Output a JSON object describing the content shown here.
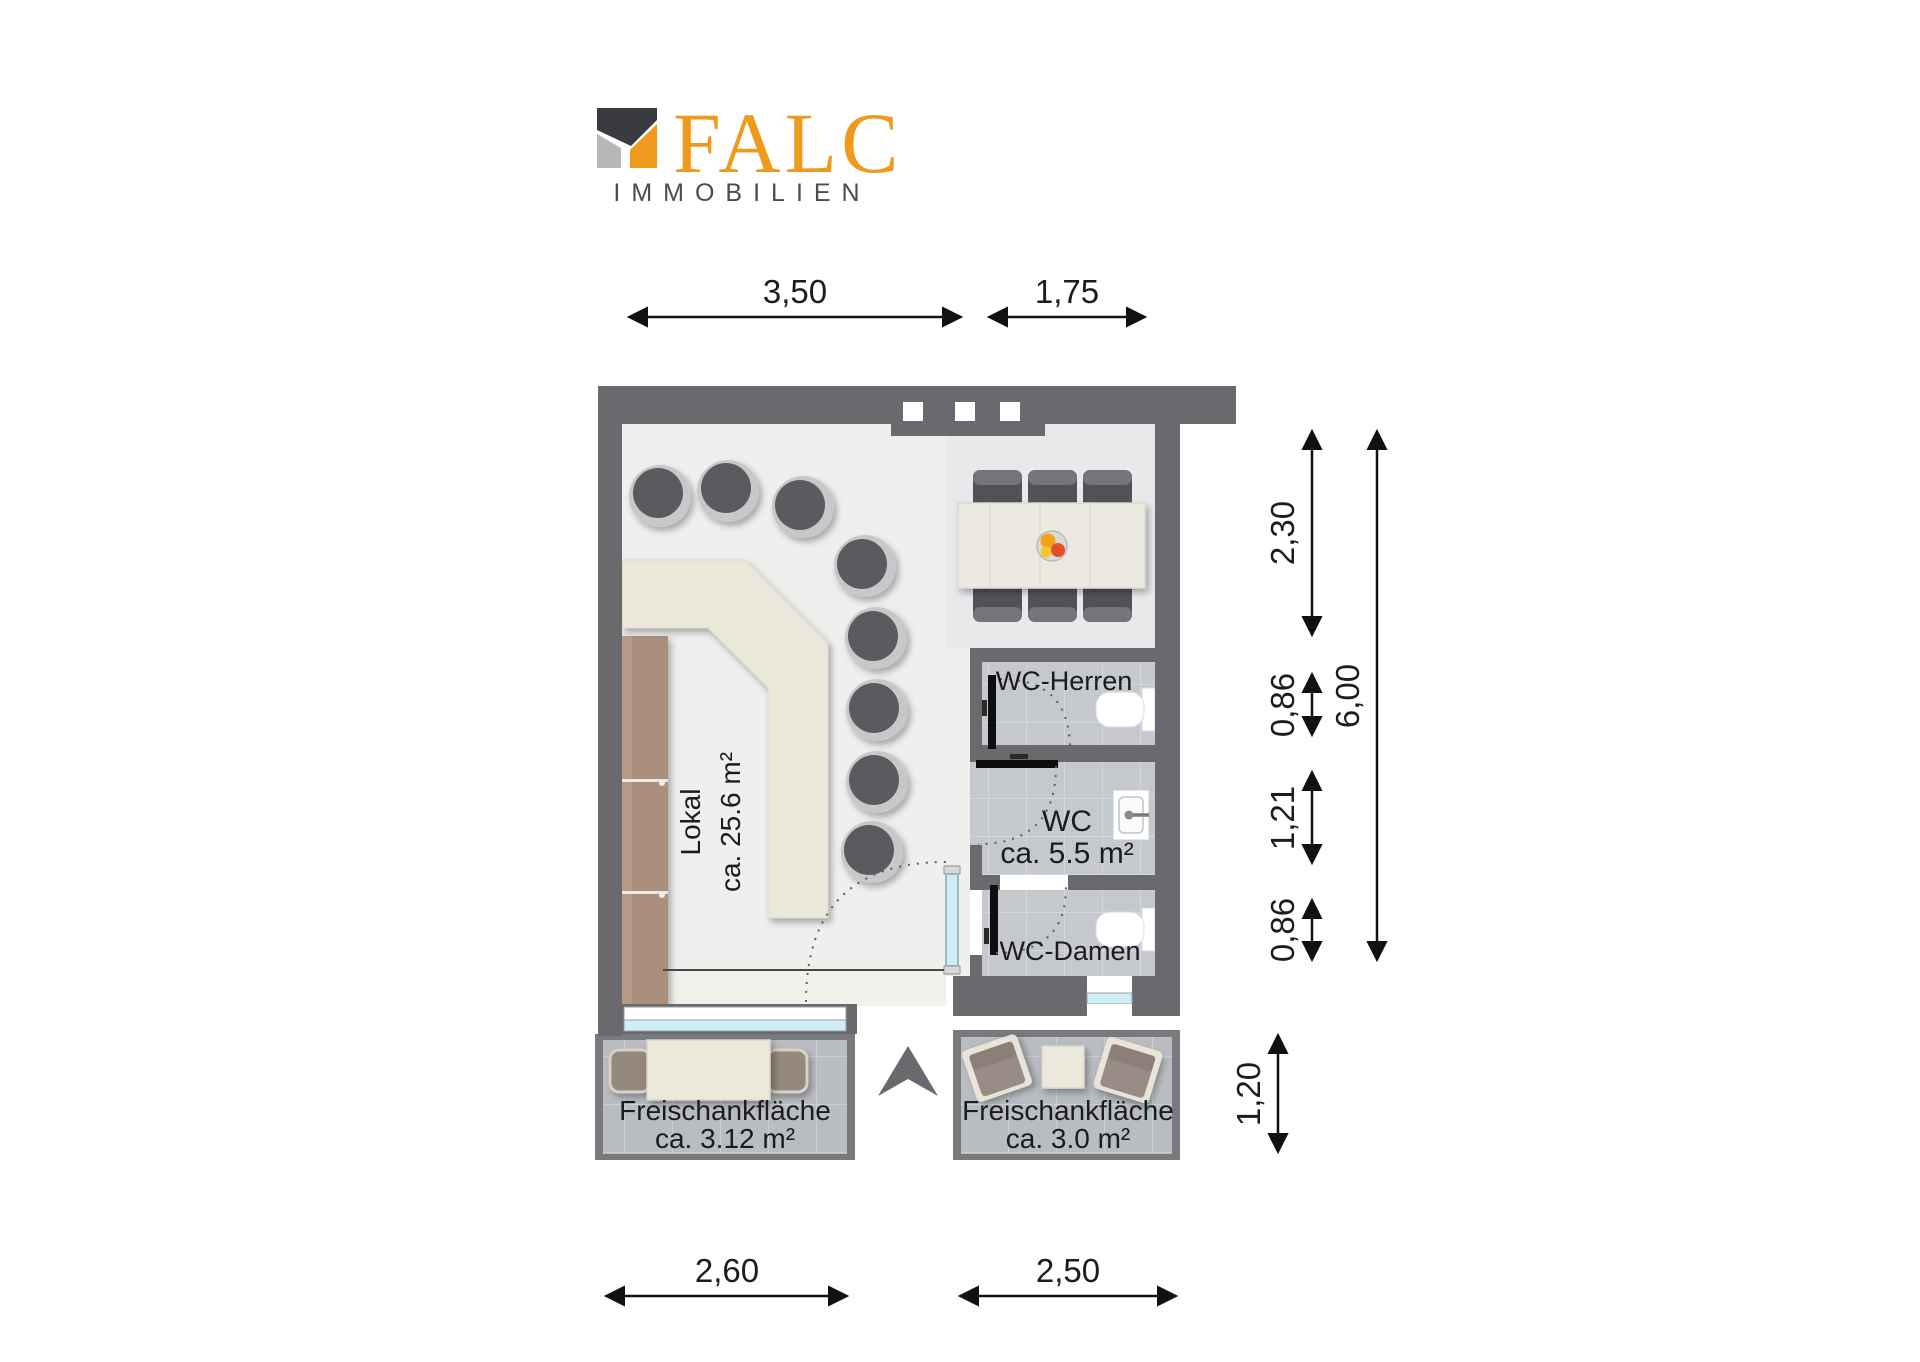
{
  "logo": {
    "brand": "FALC",
    "subtitle": "IMMOBILIEN",
    "colors": {
      "orange": "#EE9A1C",
      "dark": "#3A3B3F",
      "gray": "#B7B7B9"
    }
  },
  "rooms": {
    "lokal": {
      "name": "Lokal",
      "area": "ca. 25.6 m²"
    },
    "wc_herren": {
      "name": "WC-Herren"
    },
    "wc": {
      "name": "WC",
      "area": "ca. 5.5 m²"
    },
    "wc_damen": {
      "name": "WC-Damen"
    },
    "freischank_left": {
      "name": "Freischankfläche",
      "area": "ca. 3.12 m²"
    },
    "freischank_right": {
      "name": "Freischankfläche",
      "area": "ca. 3.0 m²"
    }
  },
  "dimensions": {
    "top": [
      {
        "label": "3,50"
      },
      {
        "label": "1,75"
      }
    ],
    "right": [
      {
        "label": "2,30"
      },
      {
        "label": "0,86"
      },
      {
        "label": "1,21"
      },
      {
        "label": "0,86"
      }
    ],
    "right_total": {
      "label": "6,00"
    },
    "right_lower": {
      "label": "1,20"
    },
    "bottom": [
      {
        "label": "2,60"
      },
      {
        "label": "2,50"
      }
    ]
  },
  "palette": {
    "wall": "#6A6A6E",
    "floor": "#EFEFEE",
    "wc_tile": "#C5C8CC",
    "terrace_tile": "#B9BDC2",
    "counter": "#EAE7DB",
    "wood": "#A98F7C",
    "window": "#CFEFF7"
  }
}
